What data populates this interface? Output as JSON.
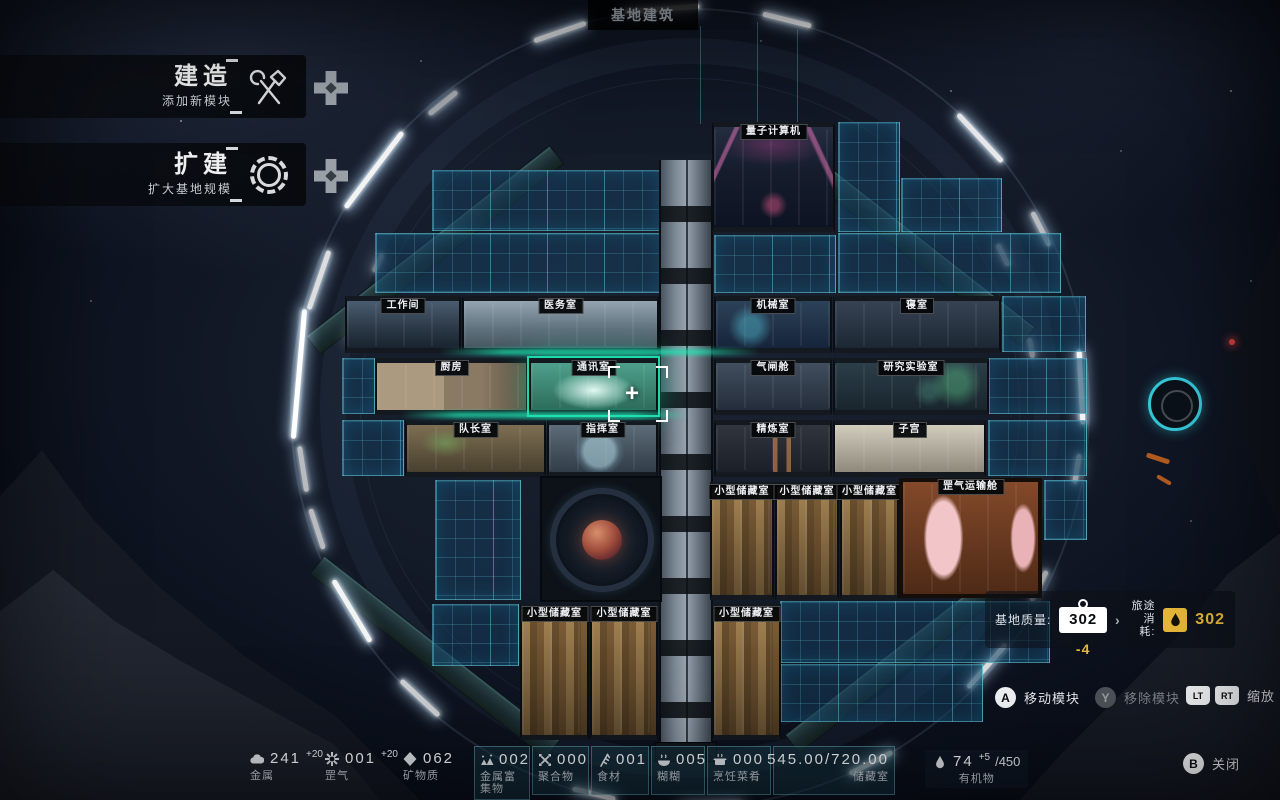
{
  "title": "基地建筑",
  "menu": {
    "build": {
      "label": "建造",
      "sublabel": "添加新模块"
    },
    "expand": {
      "label": "扩建",
      "sublabel": "扩大基地规模"
    }
  },
  "modules": [
    {
      "id": "quantum-computer",
      "label": "量子计算机",
      "selected": false
    },
    {
      "id": "workshop",
      "label": "工作间",
      "selected": false
    },
    {
      "id": "medical-room",
      "label": "医务室",
      "selected": false
    },
    {
      "id": "machinery-room",
      "label": "机械室",
      "selected": false
    },
    {
      "id": "dormitory",
      "label": "寝室",
      "selected": false
    },
    {
      "id": "kitchen",
      "label": "厨房",
      "selected": false
    },
    {
      "id": "comms-room",
      "label": "通讯室",
      "selected": true
    },
    {
      "id": "airlock",
      "label": "气闸舱",
      "selected": false
    },
    {
      "id": "research-lab",
      "label": "研究实验室",
      "selected": false
    },
    {
      "id": "captain-room",
      "label": "队长室",
      "selected": false
    },
    {
      "id": "command-room",
      "label": "指挥室",
      "selected": false
    },
    {
      "id": "refinery",
      "label": "精炼室",
      "selected": false
    },
    {
      "id": "womb",
      "label": "子宫",
      "selected": false
    },
    {
      "id": "small-storage-1",
      "label": "小型储藏室",
      "selected": false
    },
    {
      "id": "small-storage-2",
      "label": "小型储藏室",
      "selected": false
    },
    {
      "id": "small-storage-3",
      "label": "小型储藏室",
      "selected": false
    },
    {
      "id": "gas-transport-bay",
      "label": "罡气运输舱",
      "selected": false
    },
    {
      "id": "small-storage-4",
      "label": "小型储藏室",
      "selected": false
    },
    {
      "id": "small-storage-5",
      "label": "小型储藏室",
      "selected": false
    },
    {
      "id": "small-storage-6",
      "label": "小型储藏室",
      "selected": false
    }
  ],
  "mass_panel": {
    "mass_label": "基地质量:",
    "mass_value": "302",
    "mass_delta": "-4",
    "arrow": "›",
    "journey_label_line1": "旅途",
    "journey_label_line2": "消耗:",
    "journey_value": "302"
  },
  "hints": {
    "move": {
      "button": "A",
      "label": "移动模块"
    },
    "remove": {
      "button": "Y",
      "label": "移除模块"
    },
    "zoom": {
      "button_lt": "LT",
      "button_rt": "RT",
      "label": "缩放"
    },
    "close": {
      "button": "B",
      "label": "关闭"
    }
  },
  "resources": [
    {
      "name": "金属",
      "value": "241",
      "delta": "+20"
    },
    {
      "name": "罡气",
      "value": "001",
      "delta": "+20"
    },
    {
      "name": "矿物质",
      "value": "062",
      "delta": ""
    },
    {
      "name": "金属富集物",
      "value": "002",
      "delta": ""
    },
    {
      "name": "聚合物",
      "value": "000",
      "delta": ""
    },
    {
      "name": "食材",
      "value": "001",
      "delta": ""
    },
    {
      "name": "糊糊",
      "value": "005",
      "delta": ""
    },
    {
      "name": "烹饪菜肴",
      "value": "000",
      "delta": ""
    }
  ],
  "storage": {
    "value": "545.00/720.00",
    "label": "储藏室"
  },
  "organics": {
    "value": "74",
    "delta": "+5",
    "cap": "/450",
    "label": "有机物"
  },
  "colors": {
    "accent_teal": "#1fd8a8",
    "accent_yellow": "#e8b83a",
    "grid_line": "#3fb6c9"
  }
}
